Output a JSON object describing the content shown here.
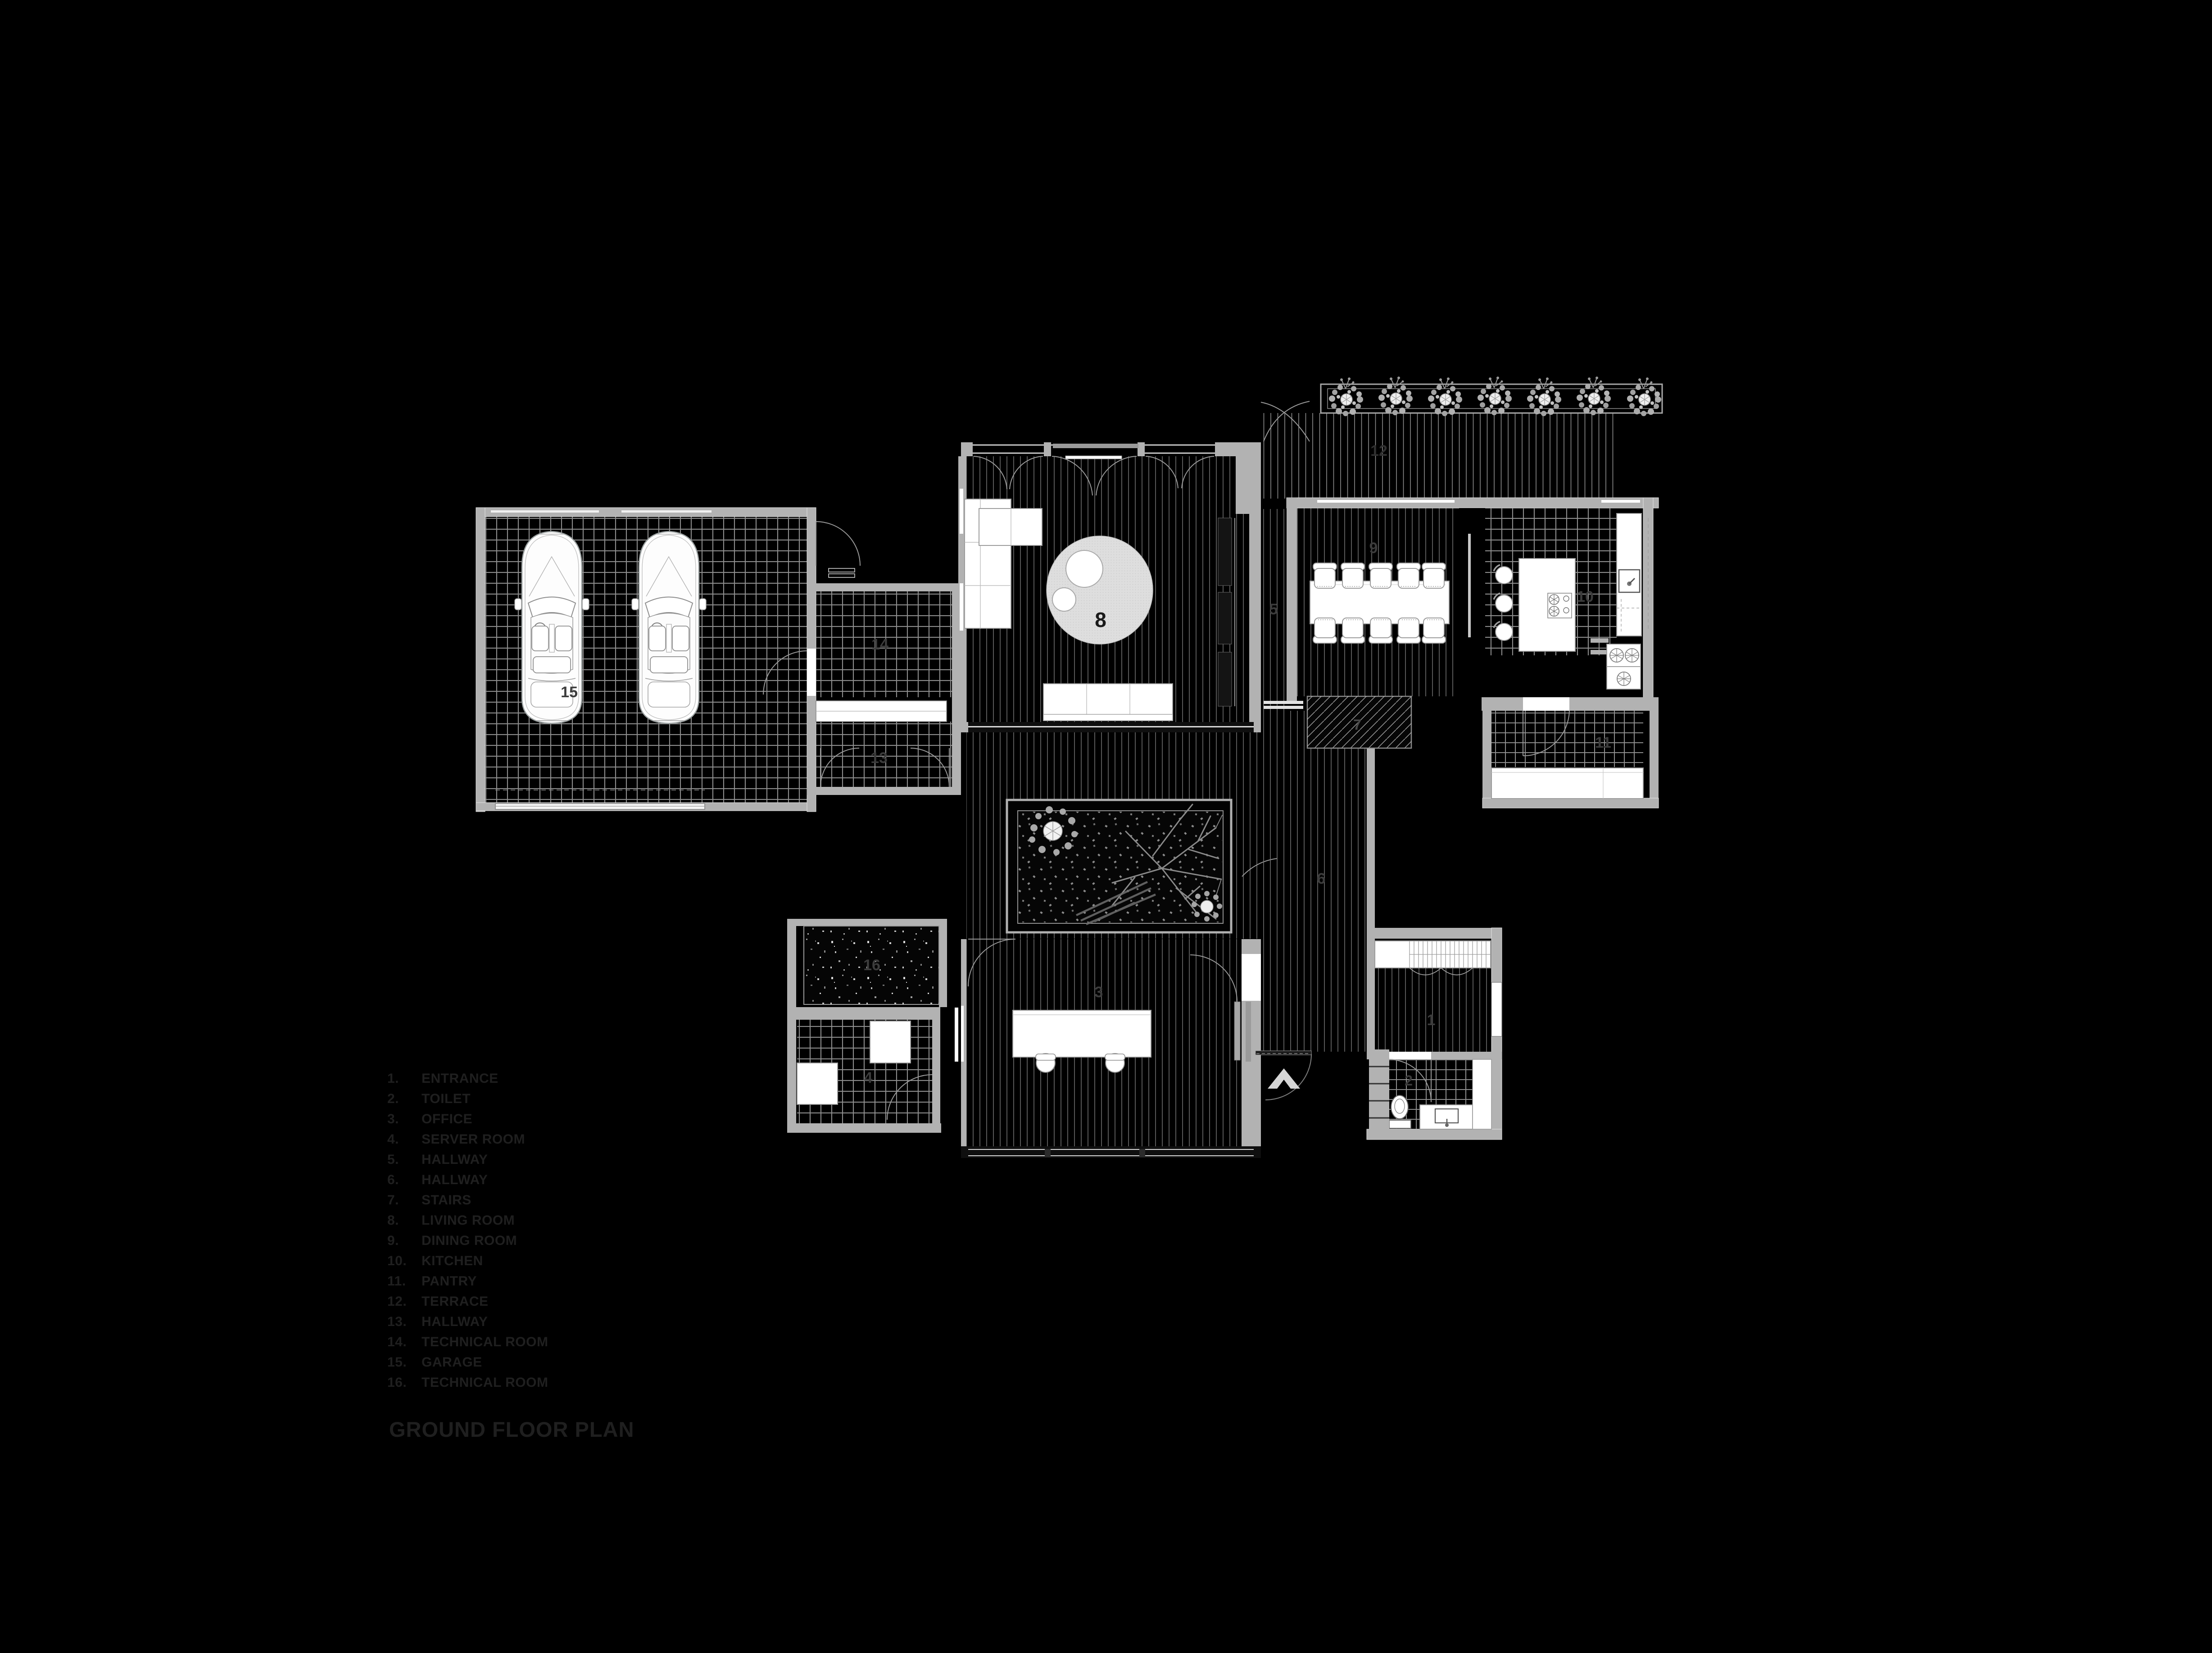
{
  "title": "GROUND FLOOR PLAN",
  "legend": {
    "items": [
      {
        "num": "1.",
        "label": "ENTRANCE"
      },
      {
        "num": "2.",
        "label": "TOILET"
      },
      {
        "num": "3.",
        "label": "OFFICE"
      },
      {
        "num": "4.",
        "label": "SERVER ROOM"
      },
      {
        "num": "5.",
        "label": "HALLWAY"
      },
      {
        "num": "6.",
        "label": "HALLWAY"
      },
      {
        "num": "7.",
        "label": "STAIRS"
      },
      {
        "num": "8.",
        "label": "LIVING ROOM"
      },
      {
        "num": "9.",
        "label": "DINING ROOM"
      },
      {
        "num": "10.",
        "label": "KITCHEN"
      },
      {
        "num": "11.",
        "label": "PANTRY"
      },
      {
        "num": "12.",
        "label": "TERRACE"
      },
      {
        "num": "13.",
        "label": "HALLWAY"
      },
      {
        "num": "14.",
        "label": "TECHNICAL ROOM"
      },
      {
        "num": "15.",
        "label": "GARAGE"
      },
      {
        "num": "16.",
        "label": "TECHNICAL ROOM"
      }
    ]
  },
  "plan": {
    "labels": {
      "r1": "1",
      "r2": "2",
      "r3": "3",
      "r4": "4",
      "r5": "5",
      "r6": "6",
      "r7": "7",
      "r8": "8",
      "r9": "9",
      "r10": "10",
      "r11": "11",
      "r12": "12",
      "r13": "13",
      "r14": "14",
      "r15": "15",
      "r16": "16"
    }
  },
  "colors": {
    "background": "#000000",
    "wall": "#b2b2b2",
    "tile_line": "#8e8e8e",
    "plank_line": "#767676",
    "furniture": "#ffffff",
    "legend_text": "#1f1f1f",
    "room_number_text": "#3c3c3c",
    "north_arrow": "#d6d6d6"
  }
}
